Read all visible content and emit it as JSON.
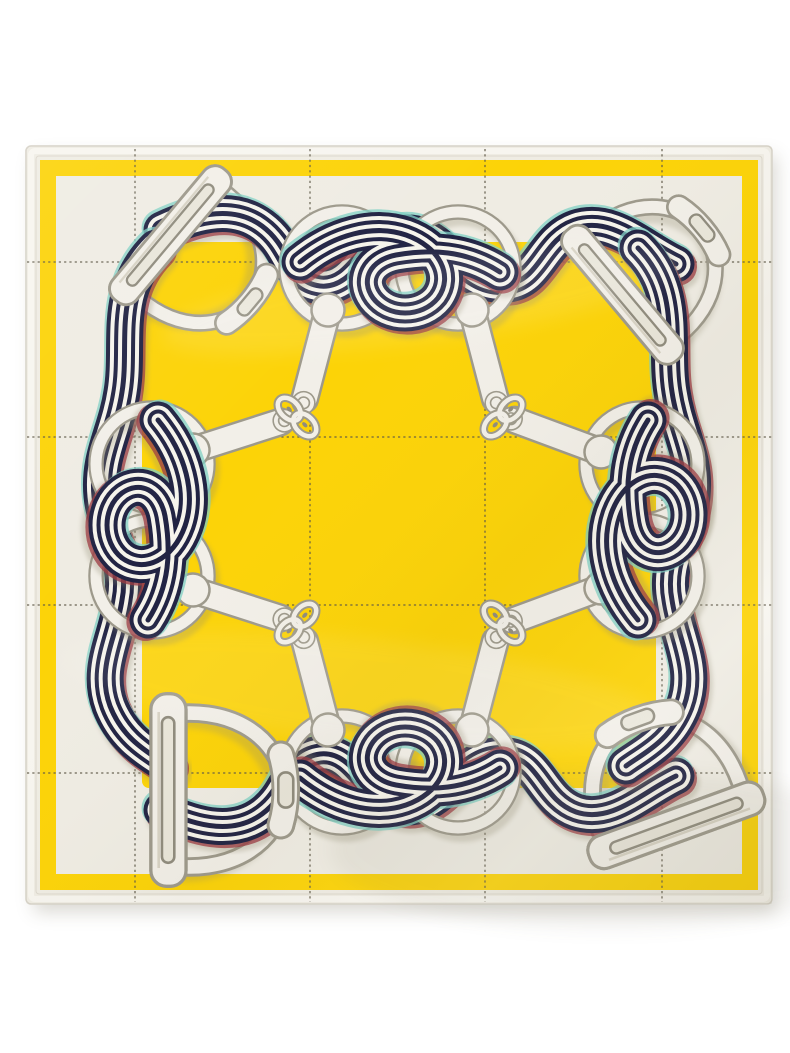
{
  "scene": {
    "type": "product-photo",
    "subject": "square silk twill scarf laid flat on a white background",
    "style": "equestrian ribbons-stirrups-and-snaffle-bits motif with windowpane stitch grid",
    "background": "#ffffff"
  },
  "scarf": {
    "description": "Cream scarf with a thin yellow border band, a large yellow centre square, a dotted stitch grid, and a frame of wavy navy-and-white striped ribbons woven through ivory rings, corner stirrup irons and snaffle-bit straps joined by anchor-chain links pointing to the centre.",
    "colors": {
      "pageBg": "#ffffff",
      "yellow": "#fcd307",
      "cream": "#efece3",
      "hem": "#f7f5ef",
      "crease": "#d8d4c8",
      "navy": "#212343",
      "stripe": "#f6f4ec",
      "teal": "#7fd0c4",
      "red": "#9c3a41",
      "ivory": "#f2efe8",
      "outline": "#9d998b",
      "slotfill": "#e9e6da",
      "slotshadow": "#8f8b7d",
      "griddot": "#5d5747",
      "shadow": "#8f8970"
    },
    "inventory": {
      "corner_stirrups": 4,
      "rings": 8,
      "ribbon_knots": 4,
      "bit_straps": 8,
      "chain_link_clusters": 4,
      "grid_lines_vertical": 4,
      "grid_lines_horizontal": 4,
      "border_bands": 1,
      "centre_square": 1
    }
  }
}
